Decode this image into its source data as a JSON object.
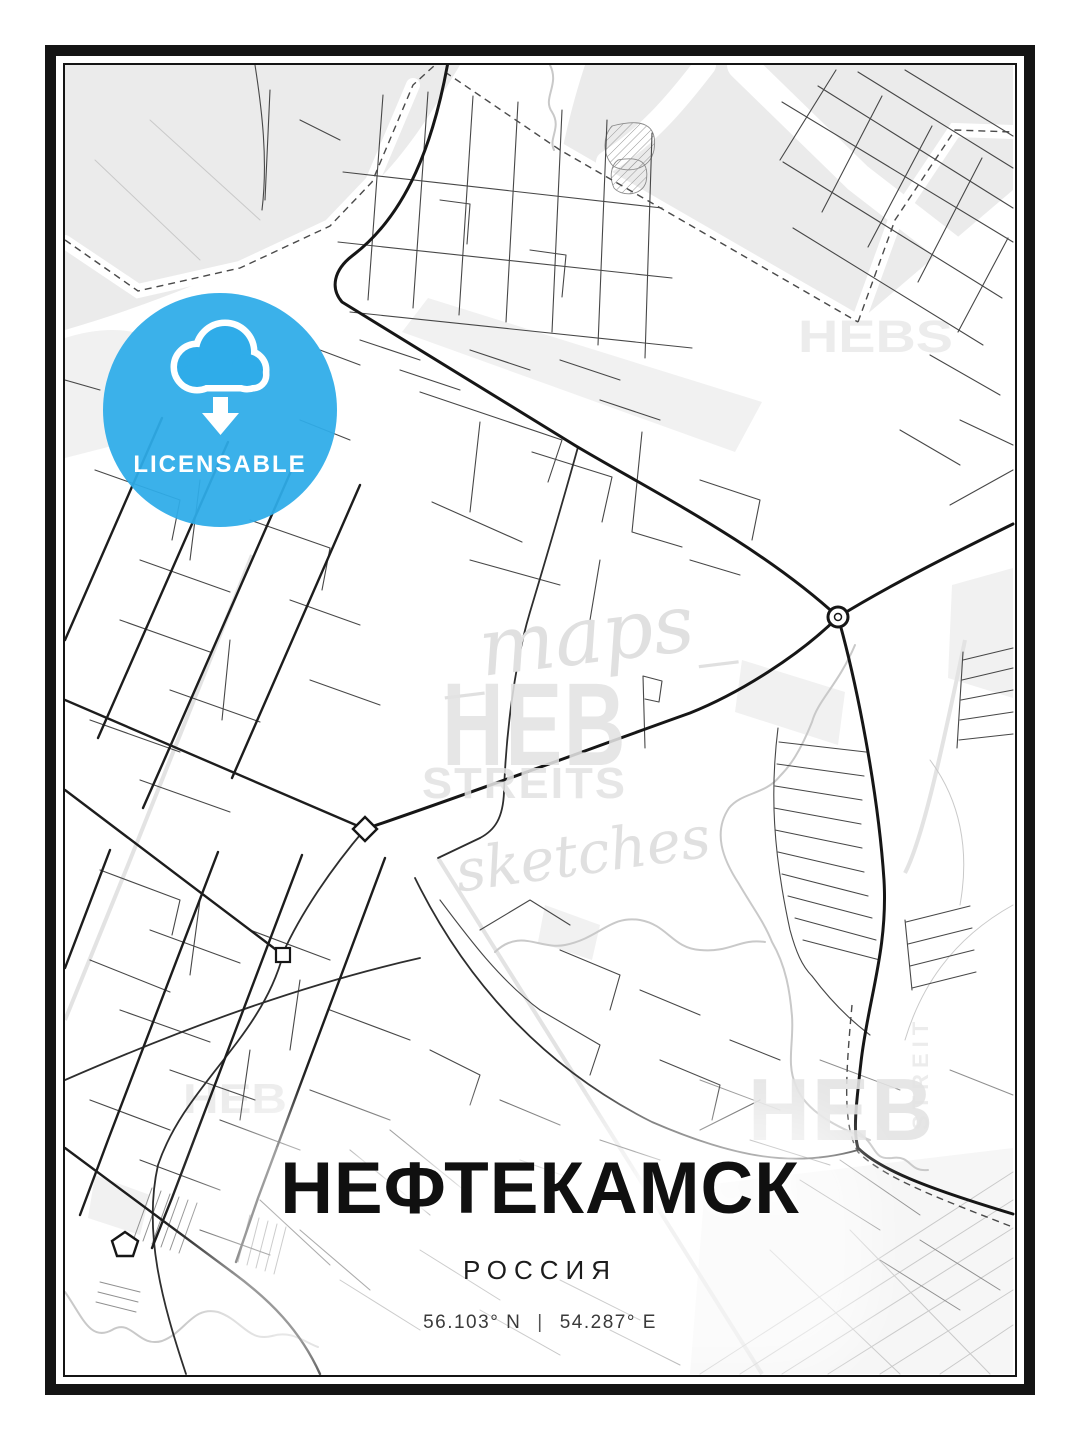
{
  "poster": {
    "title": "НЕФТЕКАМСК",
    "subtitle": "РОССИЯ",
    "coordinates": {
      "lat": "56.103° N",
      "separator": "|",
      "lon": "54.287° E"
    }
  },
  "badge": {
    "label": "LICENSABLE",
    "icon": "cloud-download-icon",
    "background_color": "#2FACE9",
    "text_color": "#FFFFFF"
  },
  "watermarks": {
    "script_top": "_maps_",
    "brand_heb": "HEB",
    "brand_streits": "STREITS",
    "script_bottom": "sketches",
    "corner_top_right": "HEBS",
    "bottom_center": "HEB",
    "bottom_left": "HEB",
    "vertical_right": "STREIT"
  },
  "map": {
    "style": "monochrome-street-map",
    "background": "#FFFFFF",
    "area_color": "#EBEBEB",
    "road_color": "#161616",
    "frame_color": "#141414"
  }
}
